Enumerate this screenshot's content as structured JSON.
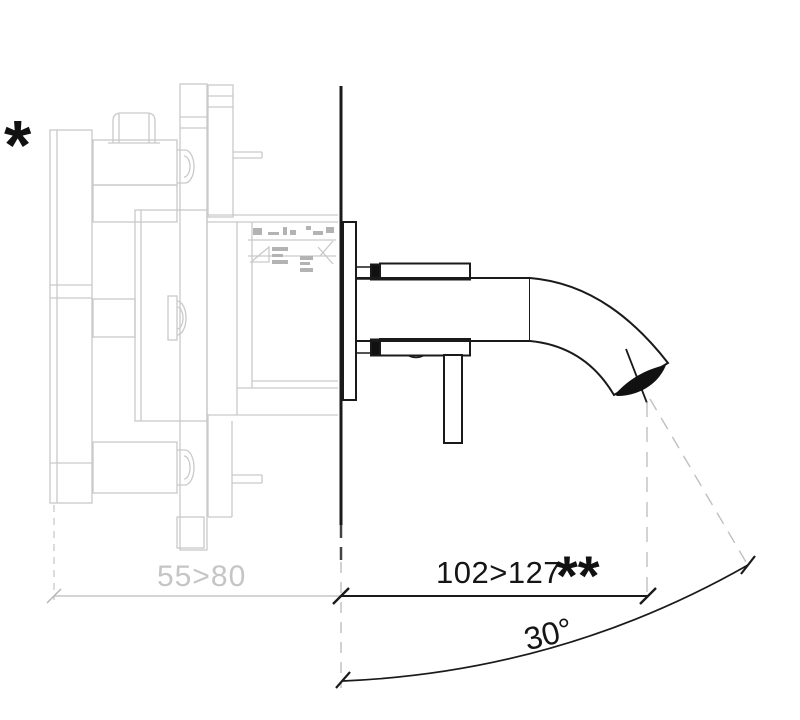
{
  "colors": {
    "trim_line": "#1a1a1a",
    "ghost_line": "#c9c9c9",
    "dimension_gray": "#c5c5c5",
    "background": "#ffffff"
  },
  "footnote": {
    "marker": "*"
  },
  "dimensions": {
    "embed_depth": {
      "label": "55>80"
    },
    "spout_reach": {
      "label": "102>127",
      "marker": "**"
    },
    "spout_angle": {
      "label": "30°"
    }
  }
}
